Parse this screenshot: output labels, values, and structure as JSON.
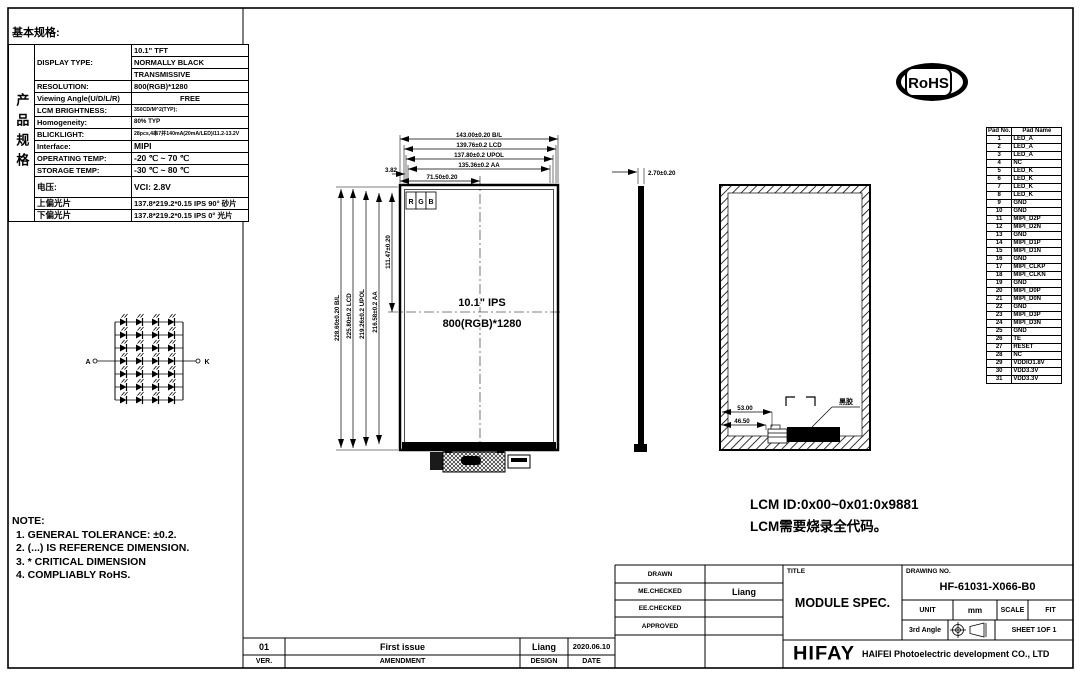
{
  "doc": {
    "section_title": "基本规格:",
    "side_label": "产品规格"
  },
  "spec": {
    "display_label": "DISPLAY TYPE:",
    "display_values": [
      "10.1\" TFT",
      "NORMALLY BLACK",
      "TRANSMISSIVE"
    ],
    "rows": [
      {
        "label": "RESOLUTION:",
        "value": "800(RGB)*1280"
      },
      {
        "label": "Viewing Angle(U/D/L/R)",
        "value": "FREE"
      },
      {
        "label": "LCM BRIGHTNESS:",
        "value": "350CD/M^2(TYP);"
      },
      {
        "label": "Homogeneity:",
        "value": "80% TYP"
      },
      {
        "label": "BLICKLIGHT:",
        "value": "28pcs,4串7并140mA(20mA/LED)/11.2-13.2V"
      },
      {
        "label": "Interface:",
        "value": "MIPI"
      },
      {
        "label": "OPERATING TEMP:",
        "value": "-20 ℃ ~ 70 ℃"
      },
      {
        "label": "STORAGE TEMP:",
        "value": "-30 ℃ ~ 80 ℃"
      },
      {
        "label": "电压:",
        "value": "VCI: 2.8V"
      },
      {
        "label": "上偏光片",
        "value": "137.8*219.2*0.15 IPS 90° 砂片"
      },
      {
        "label": "下偏光片",
        "value": "137.8*219.2*0.15 IPS 0° 光片"
      }
    ]
  },
  "notes": {
    "title": "NOTE:",
    "items": [
      "1. GENERAL TOLERANCE: ±0.2.",
      "2. (...) IS REFERENCE DIMENSION.",
      "3. * CRITICAL DIMENSION",
      "4. COMPLIABLY RoHS."
    ]
  },
  "lcm_note": {
    "line1": "LCM ID:0x00~0x01:0x9881",
    "line2": "LCM需要烧录全代码。"
  },
  "rohs_label": "RoHS",
  "panel": {
    "size_label": "10.1\" IPS",
    "resolution_label": "800(RGB)*1280",
    "rgb": [
      "R",
      "G",
      "B"
    ],
    "glue_label": "黑胶"
  },
  "dims": {
    "top": [
      "143.00±0.20 B/L",
      "139.76±0.2 LCD",
      "137.80±0.2 UPOL",
      "135.36±0.2 AA"
    ],
    "edge_offset": "3.82",
    "half_width": "71.50±0.20",
    "left": [
      "228.60±0.20 B/L",
      "225.80±0.2 LCD",
      "219.26±0.2 UPOL",
      "216.58±0.2 AA"
    ],
    "half_height": "111.47±0.20",
    "thickness": "2.70±0.20",
    "fpc_dim_a": "53.00",
    "fpc_dim_b": "46.50"
  },
  "led_circuit": {
    "rows": 7,
    "cols": 4,
    "anode_label": "A",
    "cathode_label": "K"
  },
  "pad_table": {
    "headers": [
      "Pad No.",
      "Pad Name"
    ],
    "rows": [
      [
        "1",
        "LED_A"
      ],
      [
        "2",
        "LED_A"
      ],
      [
        "3",
        "LED_A"
      ],
      [
        "4",
        "NC"
      ],
      [
        "5",
        "LED_K"
      ],
      [
        "6",
        "LED_K"
      ],
      [
        "7",
        "LED_K"
      ],
      [
        "8",
        "LED_K"
      ],
      [
        "9",
        "GND"
      ],
      [
        "10",
        "GND"
      ],
      [
        "11",
        "MIPI_D2P"
      ],
      [
        "12",
        "MIPI_D2N"
      ],
      [
        "13",
        "GND"
      ],
      [
        "14",
        "MIPI_D1P"
      ],
      [
        "15",
        "MIPI_D1N"
      ],
      [
        "16",
        "GND"
      ],
      [
        "17",
        "MIPI_CLKP"
      ],
      [
        "18",
        "MIPI_CLKN"
      ],
      [
        "19",
        "GND"
      ],
      [
        "20",
        "MIPI_D0P"
      ],
      [
        "21",
        "MIPI_D0N"
      ],
      [
        "22",
        "GND"
      ],
      [
        "23",
        "MIPI_D3P"
      ],
      [
        "24",
        "MIPI_D3N"
      ],
      [
        "25",
        "GND"
      ],
      [
        "26",
        "TE"
      ],
      [
        "27",
        "RESET"
      ],
      [
        "28",
        "NC"
      ],
      [
        "29",
        "VDDIO1.8V"
      ],
      [
        "30",
        "VDD3.3V"
      ],
      [
        "31",
        "VDD3.3V"
      ]
    ]
  },
  "title_block": {
    "drawn_label": "DRAWN",
    "me_checked_label": "ME.CHECKED",
    "ee_checked_label": "EE.CHECKED",
    "approved_label": "APPROVED",
    "me_checked_value": "Liang",
    "title_label": "TITLE",
    "title": "MODULE SPEC.",
    "drawing_no_label": "DRAWING NO.",
    "drawing_no": "HF-61031-X066-B0",
    "unit_label": "UNIT",
    "unit_value": "mm",
    "scale_label": "SCALE",
    "fit_label": "FIT",
    "angle_label": "3rd Angle",
    "sheet_label": "SHEET 1OF 1",
    "logo": "HIFAY",
    "company": "HAIFEI Photoelectric development CO., LTD"
  },
  "revision": {
    "row": {
      "ver": "01",
      "amendment": "First issue",
      "design": "Liang",
      "date": "2020.06.10"
    },
    "headers": {
      "ver": "VER.",
      "amendment": "AMENDMENT",
      "design": "DESIGN",
      "date": "DATE"
    }
  }
}
